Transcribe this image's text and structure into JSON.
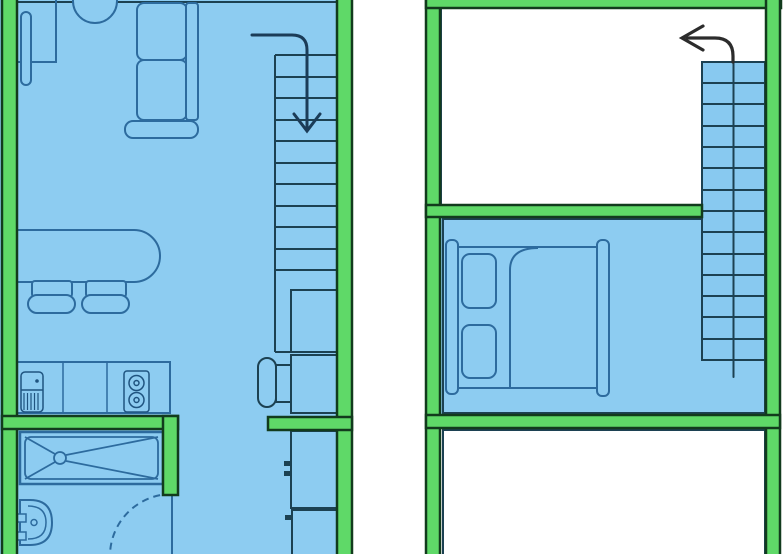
{
  "canvas": {
    "width": 783,
    "height": 554
  },
  "plan": {
    "kind": "two-level-apartment-floor-plan",
    "left_unit_rooms": [
      "living-area",
      "kitchen",
      "hallway",
      "bathroom",
      "staircase"
    ],
    "right_unit_rooms": [
      "void-room",
      "bedroom",
      "lower-room",
      "staircase"
    ]
  },
  "colors": {
    "bg": "#ffffff",
    "floor": "#8dccf1",
    "stair": "#88c9f0",
    "wall": "#5fd968",
    "wallstroke": "#123b1d",
    "room": "#1c4152",
    "line": "#2d6b9e",
    "dark": "#1f5480",
    "arrowL": "#1b3c58",
    "arrowR": "#2c2c2c"
  },
  "elements": [
    {
      "name": "background",
      "t": "rect",
      "x": 0,
      "y": 0,
      "w": 783,
      "h": 554,
      "f": "bg"
    },
    {
      "name": "left-unit-floor",
      "t": "rect",
      "x": 0,
      "y": 0,
      "w": 352,
      "h": 554,
      "f": "floor"
    },
    {
      "name": "left-unit-top-edge",
      "t": "line",
      "x1": 17,
      "y1": 2,
      "x2": 337,
      "y2": 2,
      "s": "room",
      "sw": 2
    },
    {
      "name": "desk",
      "t": "rect",
      "x": 17,
      "y": -4,
      "w": 39,
      "h": 66,
      "s": "line",
      "sw": 2
    },
    {
      "name": "desk-monitor-bar",
      "t": "rect",
      "x": 21,
      "y": 12,
      "w": 10,
      "h": 73,
      "rx": 5,
      "s": "line",
      "sw": 2,
      "f": "floor"
    },
    {
      "name": "desk-chair",
      "t": "circle",
      "cx": 95,
      "cy": 1,
      "r": 22,
      "s": "line",
      "sw": 2,
      "f": "floor"
    },
    {
      "name": "sofa-armrest",
      "t": "rect",
      "x": 125,
      "y": 121,
      "w": 73,
      "h": 17,
      "rx": 8,
      "s": "line",
      "sw": 2,
      "f": "floor"
    },
    {
      "name": "sofa-cushion-1",
      "t": "rect",
      "x": 137,
      "y": 3,
      "w": 50,
      "h": 57,
      "rx": 7,
      "s": "line",
      "sw": 2,
      "f": "floor"
    },
    {
      "name": "sofa-cushion-2",
      "t": "rect",
      "x": 137,
      "y": 60,
      "w": 50,
      "h": 60,
      "rx": 7,
      "s": "line",
      "sw": 2,
      "f": "floor"
    },
    {
      "name": "sofa-backrest",
      "t": "rect",
      "x": 186,
      "y": 3,
      "w": 12,
      "h": 117,
      "rx": 3,
      "s": "line",
      "sw": 2,
      "f": "floor"
    },
    {
      "name": "dining-table",
      "t": "path",
      "d": "M17,230 H134 a26,26 0 0 1 0,52 H17",
      "s": "line",
      "sw": 2,
      "f": "floor"
    },
    {
      "name": "dining-chair-1-back",
      "t": "rect",
      "x": 32,
      "y": 281,
      "w": 40,
      "h": 16,
      "rx": 3,
      "s": "line",
      "sw": 2,
      "f": "floor"
    },
    {
      "name": "dining-chair-1-seat",
      "t": "rect",
      "x": 28,
      "y": 295,
      "w": 47,
      "h": 18,
      "rx": 9,
      "s": "line",
      "sw": 2,
      "f": "floor"
    },
    {
      "name": "dining-chair-2-back",
      "t": "rect",
      "x": 86,
      "y": 281,
      "w": 40,
      "h": 16,
      "rx": 3,
      "s": "line",
      "sw": 2,
      "f": "floor"
    },
    {
      "name": "dining-chair-2-seat",
      "t": "rect",
      "x": 82,
      "y": 295,
      "w": 47,
      "h": 18,
      "rx": 9,
      "s": "line",
      "sw": 2,
      "f": "floor"
    },
    {
      "name": "kitchen-counter",
      "t": "rect",
      "x": 17,
      "y": 362,
      "w": 153,
      "h": 51,
      "s": "line",
      "sw": 2,
      "f": "floor"
    },
    {
      "name": "counter-divider-1",
      "t": "line",
      "x1": 63,
      "y1": 362,
      "x2": 63,
      "y2": 413,
      "s": "line",
      "sw": 1.5
    },
    {
      "name": "counter-divider-2",
      "t": "line",
      "x1": 107,
      "y1": 362,
      "x2": 107,
      "y2": 413,
      "s": "line",
      "sw": 1.5
    },
    {
      "name": "kitchen-sink",
      "t": "rect",
      "x": 21,
      "y": 372,
      "w": 22,
      "h": 40,
      "rx": 4,
      "s": "dark",
      "sw": 1.5
    },
    {
      "name": "sink-divider",
      "t": "line",
      "x1": 21,
      "y1": 390,
      "x2": 43,
      "y2": 390,
      "s": "dark",
      "sw": 1.5
    },
    {
      "name": "sink-faucet-dot",
      "t": "circle",
      "cx": 37,
      "cy": 381,
      "r": 1.8,
      "f": "dark"
    },
    {
      "name": "sink-drainboard-hatch",
      "t": "path",
      "d": "M24,393 V410 M27.5,393 V410 M31,393 V410 M34.5,393 V410 M38,393 V410",
      "s": "dark",
      "sw": 1.2
    },
    {
      "name": "stove",
      "t": "rect",
      "x": 124,
      "y": 371,
      "w": 25,
      "h": 41,
      "rx": 3,
      "s": "dark",
      "sw": 1.5
    },
    {
      "name": "stove-burner-1",
      "t": "circle",
      "cx": 136.5,
      "cy": 383,
      "r": 7.5,
      "s": "dark",
      "sw": 1.5
    },
    {
      "name": "stove-burner-1-dot",
      "t": "circle",
      "cx": 136.5,
      "cy": 383,
      "r": 2.5,
      "s": "dark",
      "sw": 1.5
    },
    {
      "name": "stove-burner-2",
      "t": "circle",
      "cx": 136.5,
      "cy": 400,
      "r": 7.5,
      "s": "dark",
      "sw": 1.5
    },
    {
      "name": "stove-burner-2-dot",
      "t": "circle",
      "cx": 136.5,
      "cy": 400,
      "r": 2.5,
      "s": "dark",
      "sw": 1.5
    },
    {
      "name": "stairs-left-steps",
      "t": "hlines",
      "x1": 275,
      "x2": 337,
      "ys": [
        55,
        77,
        98,
        120,
        141,
        163,
        184,
        206,
        227,
        249,
        270
      ],
      "s": "room",
      "sw": 2
    },
    {
      "name": "stairs-left-side",
      "t": "line",
      "x1": 275,
      "y1": 55,
      "x2": 275,
      "y2": 352,
      "s": "room",
      "sw": 2
    },
    {
      "name": "stairs-left-bottom",
      "t": "line",
      "x1": 275,
      "y1": 352,
      "x2": 291,
      "y2": 352,
      "s": "room",
      "sw": 2
    },
    {
      "name": "under-stair-closet",
      "t": "rect",
      "x": 291,
      "y": 290,
      "w": 49,
      "h": 62,
      "s": "room",
      "sw": 2
    },
    {
      "name": "side-table",
      "t": "rect",
      "x": 291,
      "y": 355,
      "w": 49,
      "h": 58,
      "s": "room",
      "sw": 2
    },
    {
      "name": "stool-connector",
      "t": "rect",
      "x": 276,
      "y": 365,
      "w": 15,
      "h": 37,
      "s": "room",
      "sw": 2,
      "f": "floor"
    },
    {
      "name": "stool",
      "t": "rect",
      "x": 258,
      "y": 358,
      "w": 18,
      "h": 49,
      "rx": 9,
      "s": "room",
      "sw": 2,
      "f": "floor"
    },
    {
      "name": "tall-cabinet-1",
      "t": "rect",
      "x": 291,
      "y": 431,
      "w": 46,
      "h": 77,
      "s": "room",
      "sw": 2,
      "f": "floor"
    },
    {
      "name": "cabinet-knob-1",
      "t": "rect",
      "x": 284,
      "y": 461,
      "w": 8,
      "h": 5,
      "f": "room"
    },
    {
      "name": "cabinet-knob-2",
      "t": "rect",
      "x": 284,
      "y": 471,
      "w": 8,
      "h": 5,
      "f": "room"
    },
    {
      "name": "tall-cabinet-2",
      "t": "rect",
      "x": 292,
      "y": 510,
      "w": 45,
      "h": 46,
      "s": "room",
      "sw": 2,
      "f": "floor"
    },
    {
      "name": "cabinet-knob-3",
      "t": "rect",
      "x": 285,
      "y": 515,
      "w": 8,
      "h": 5,
      "f": "room"
    },
    {
      "name": "shower-tray",
      "t": "rect",
      "x": 20,
      "y": 432,
      "w": 143,
      "h": 52,
      "s": "line",
      "sw": 2.5
    },
    {
      "name": "shower-tray-inner",
      "t": "rect",
      "x": 25,
      "y": 437,
      "w": 133,
      "h": 42,
      "rx": 6,
      "s": "line",
      "sw": 1.8
    },
    {
      "name": "shower-diag-1",
      "t": "line",
      "x1": 25,
      "y1": 437,
      "x2": 55,
      "y2": 454,
      "s": "line",
      "sw": 1.8
    },
    {
      "name": "shower-diag-2",
      "t": "line",
      "x1": 25,
      "y1": 479,
      "x2": 55,
      "y2": 462,
      "s": "line",
      "sw": 1.8
    },
    {
      "name": "shower-diag-3",
      "t": "line",
      "x1": 158,
      "y1": 437,
      "x2": 66,
      "y2": 455,
      "s": "line",
      "sw": 1.8
    },
    {
      "name": "shower-diag-4",
      "t": "line",
      "x1": 158,
      "y1": 479,
      "x2": 66,
      "y2": 461,
      "s": "line",
      "sw": 1.8
    },
    {
      "name": "shower-drain",
      "t": "circle",
      "cx": 60,
      "cy": 458,
      "r": 6,
      "s": "line",
      "sw": 1.8,
      "f": "floor"
    },
    {
      "name": "washbasin",
      "t": "path",
      "d": "M20,500 H30 Q52,500 52,522.5 Q52,545 30,545 H20 Z",
      "s": "line",
      "sw": 2,
      "f": "floor"
    },
    {
      "name": "washbasin-inner",
      "t": "path",
      "d": "M28,506 Q46,506 46,522.5 Q46,539 28,539",
      "s": "line",
      "sw": 1.5
    },
    {
      "name": "basin-tap-1",
      "t": "rect",
      "x": 16,
      "y": 514,
      "w": 10,
      "h": 8,
      "s": "line",
      "sw": 1.5,
      "f": "floor"
    },
    {
      "name": "basin-tap-2",
      "t": "rect",
      "x": 16,
      "y": 532,
      "w": 10,
      "h": 8,
      "s": "line",
      "sw": 1.5,
      "f": "floor"
    },
    {
      "name": "basin-drain",
      "t": "circle",
      "cx": 34,
      "cy": 522.5,
      "r": 3,
      "s": "line",
      "sw": 1.5
    },
    {
      "name": "bathroom-door-leaf",
      "t": "line",
      "x1": 172,
      "y1": 496,
      "x2": 172,
      "y2": 554,
      "s": "line",
      "sw": 2
    },
    {
      "name": "bathroom-door-swing-arc",
      "t": "path",
      "d": "M172,494 A62,62 0 0 0 110,554",
      "s": "line",
      "sw": 2,
      "dash": "7,5"
    },
    {
      "name": "wall-left-outer",
      "t": "rect",
      "x": 2,
      "y": -4,
      "w": 15,
      "h": 562,
      "f": "wall",
      "s": "wallstroke",
      "sw": 2.5
    },
    {
      "name": "wall-left-unit-right",
      "t": "rect",
      "x": 337,
      "y": -4,
      "w": 15,
      "h": 562,
      "f": "wall",
      "s": "wallstroke",
      "sw": 2.5
    },
    {
      "name": "wall-bathroom-top",
      "t": "rect",
      "x": 2,
      "y": 416,
      "w": 176,
      "h": 13,
      "f": "wall",
      "s": "wallstroke",
      "sw": 2.5
    },
    {
      "name": "wall-bathroom-side",
      "t": "rect",
      "x": 163,
      "y": 416,
      "w": 15,
      "h": 79,
      "f": "wall",
      "s": "wallstroke",
      "sw": 2.5
    },
    {
      "name": "wall-hall-stub",
      "t": "rect",
      "x": 268,
      "y": 417,
      "w": 84,
      "h": 13,
      "f": "wall",
      "s": "wallstroke",
      "sw": 2.5
    },
    {
      "name": "stairs-down-arrow",
      "t": "path",
      "d": "M252,35 H292 Q307,35 307,50 V130",
      "s": "arrowL",
      "sw": 3,
      "cap": "round"
    },
    {
      "name": "stairs-down-arrowhead",
      "t": "polyline",
      "pts": "294,114 307,131 320,114",
      "s": "arrowL",
      "sw": 3,
      "cap": "round"
    },
    {
      "name": "void-room-outline",
      "t": "rect",
      "x": 441,
      "y": 8,
      "w": 326,
      "h": 197,
      "s": "room",
      "sw": 2,
      "f": "bg"
    },
    {
      "name": "bedroom-floor",
      "t": "rect",
      "x": 440,
      "y": 217,
      "w": 327,
      "h": 198,
      "f": "floor"
    },
    {
      "name": "bedroom-outline",
      "t": "rect",
      "x": 443,
      "y": 219,
      "w": 322,
      "h": 194,
      "s": "room",
      "sw": 2
    },
    {
      "name": "lower-room-outline",
      "t": "rect",
      "x": 443,
      "y": 430,
      "w": 322,
      "h": 128,
      "s": "room",
      "sw": 2,
      "f": "bg"
    },
    {
      "name": "bed-headboard",
      "t": "rect",
      "x": 446,
      "y": 240,
      "w": 12,
      "h": 154,
      "rx": 5,
      "s": "line",
      "sw": 2,
      "f": "floor"
    },
    {
      "name": "bed-frame",
      "t": "rect",
      "x": 458,
      "y": 247,
      "w": 140,
      "h": 141,
      "s": "line",
      "sw": 2,
      "f": "floor"
    },
    {
      "name": "bed-pillow-1",
      "t": "rect",
      "x": 462,
      "y": 254,
      "w": 34,
      "h": 54,
      "rx": 8,
      "s": "line",
      "sw": 2
    },
    {
      "name": "bed-pillow-2",
      "t": "rect",
      "x": 462,
      "y": 325,
      "w": 34,
      "h": 53,
      "rx": 8,
      "s": "line",
      "sw": 2
    },
    {
      "name": "bed-blanket-line",
      "t": "path",
      "d": "M510,388 V270 Q510,248 538,248",
      "s": "line",
      "sw": 2
    },
    {
      "name": "bed-footboard",
      "t": "rect",
      "x": 597,
      "y": 240,
      "w": 12,
      "h": 156,
      "rx": 5,
      "s": "line",
      "sw": 2,
      "f": "floor"
    },
    {
      "name": "stairs-right-box",
      "t": "rect",
      "x": 702,
      "y": 62,
      "w": 63,
      "h": 298,
      "f": "stair",
      "s": "room",
      "sw": 2
    },
    {
      "name": "stairs-right-steps",
      "t": "hlines",
      "x1": 702,
      "x2": 765,
      "ys": [
        83,
        104,
        126,
        147,
        168,
        190,
        211,
        232,
        254,
        275,
        296,
        317,
        339
      ],
      "s": "room",
      "sw": 2
    },
    {
      "name": "stairs-right-center-line",
      "t": "line",
      "x1": 733.5,
      "y1": 62,
      "x2": 733.5,
      "y2": 377,
      "s": "room",
      "sw": 2,
      "cap": "round"
    },
    {
      "name": "wall-right-unit-left",
      "t": "rect",
      "x": 426,
      "y": -4,
      "w": 14,
      "h": 562,
      "f": "wall",
      "s": "wallstroke",
      "sw": 2.5
    },
    {
      "name": "wall-right-unit-top",
      "t": "rect",
      "x": 426,
      "y": -4,
      "w": 355,
      "h": 12,
      "f": "wall",
      "s": "wallstroke",
      "sw": 2.5
    },
    {
      "name": "wall-right-unit-right",
      "t": "rect",
      "x": 766,
      "y": -4,
      "w": 14,
      "h": 562,
      "f": "wall",
      "s": "wallstroke",
      "sw": 2.5
    },
    {
      "name": "wall-bedroom-top",
      "t": "rect",
      "x": 426,
      "y": 205,
      "w": 276,
      "h": 12,
      "f": "wall",
      "s": "wallstroke",
      "sw": 2.5
    },
    {
      "name": "wall-bedroom-bottom",
      "t": "rect",
      "x": 426,
      "y": 415,
      "w": 354,
      "h": 13,
      "f": "wall",
      "s": "wallstroke",
      "sw": 2.5
    },
    {
      "name": "stairs-up-arrow",
      "t": "path",
      "d": "M733,62 V56 Q733,38 715,38 H687",
      "s": "arrowR",
      "sw": 3.2,
      "cap": "round"
    },
    {
      "name": "stairs-up-arrowhead",
      "t": "polyline",
      "pts": "703,26 682,38 703,50",
      "s": "arrowR",
      "sw": 3.2,
      "cap": "round"
    }
  ]
}
